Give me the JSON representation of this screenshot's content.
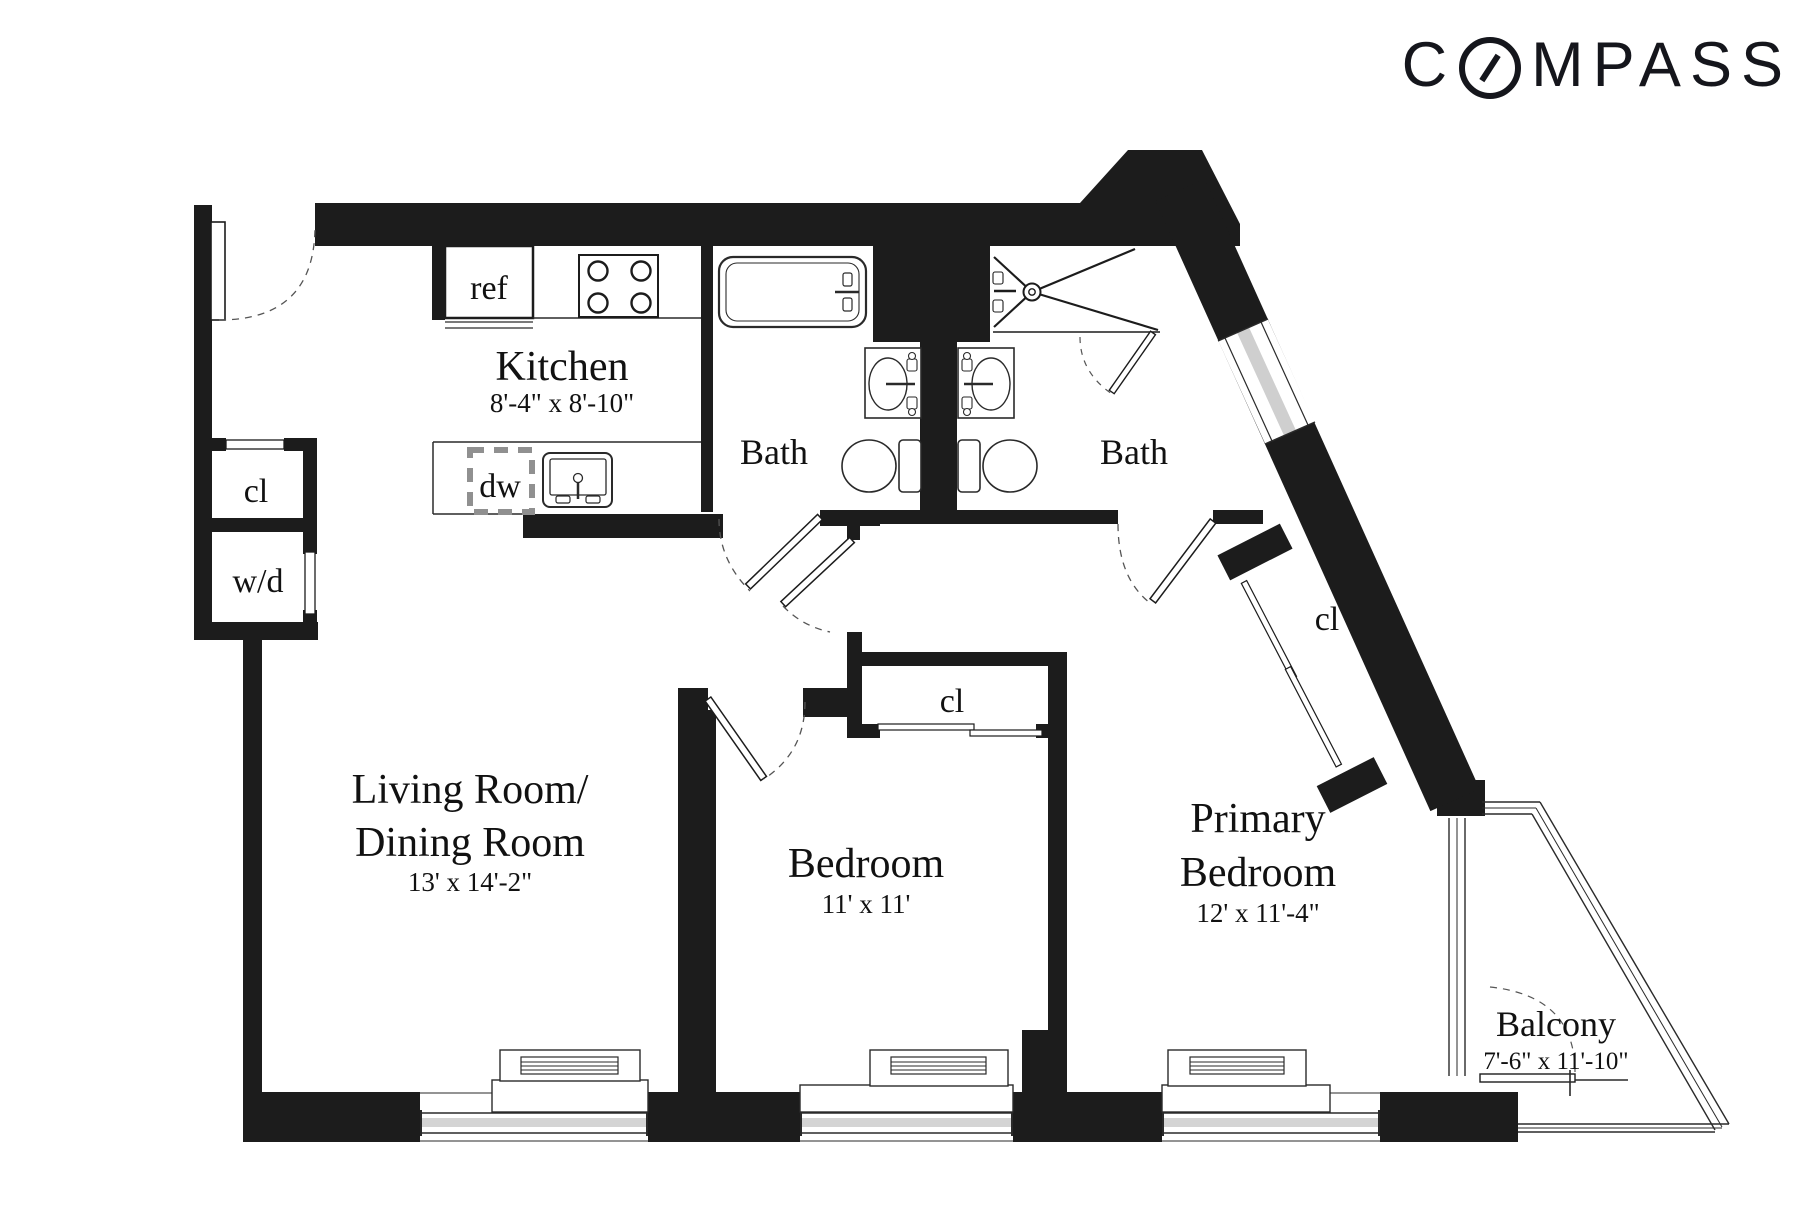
{
  "brand": {
    "name": "COMPASS",
    "prefix": "C",
    "suffix": "MPASS"
  },
  "rooms": {
    "kitchen": {
      "name": "Kitchen",
      "dims": "8'-4\" x 8'-10\""
    },
    "living": {
      "name_line1": "Living Room/",
      "name_line2": "Dining Room",
      "dims": "13' x 14'-2\""
    },
    "bedroom": {
      "name": "Bedroom",
      "dims": "11' x 11'"
    },
    "primary": {
      "name_line1": "Primary",
      "name_line2": "Bedroom",
      "dims": "12' x 11'-4\""
    },
    "bath1": {
      "name": "Bath"
    },
    "bath2": {
      "name": "Bath"
    },
    "balcony": {
      "name": "Balcony",
      "dims": "7'-6\" x 11'-10\""
    }
  },
  "fixtures": {
    "refrigerator": "ref",
    "dishwasher": "dw",
    "washer_dryer": "w/d",
    "closet_entry": "cl",
    "closet_bedroom": "cl",
    "closet_primary": "cl"
  },
  "colors": {
    "wall": "#1c1c1c",
    "line": "#2a2a2a",
    "glass": "#cfcfcf",
    "dash_gray": "#909090",
    "arc": "#555555"
  }
}
